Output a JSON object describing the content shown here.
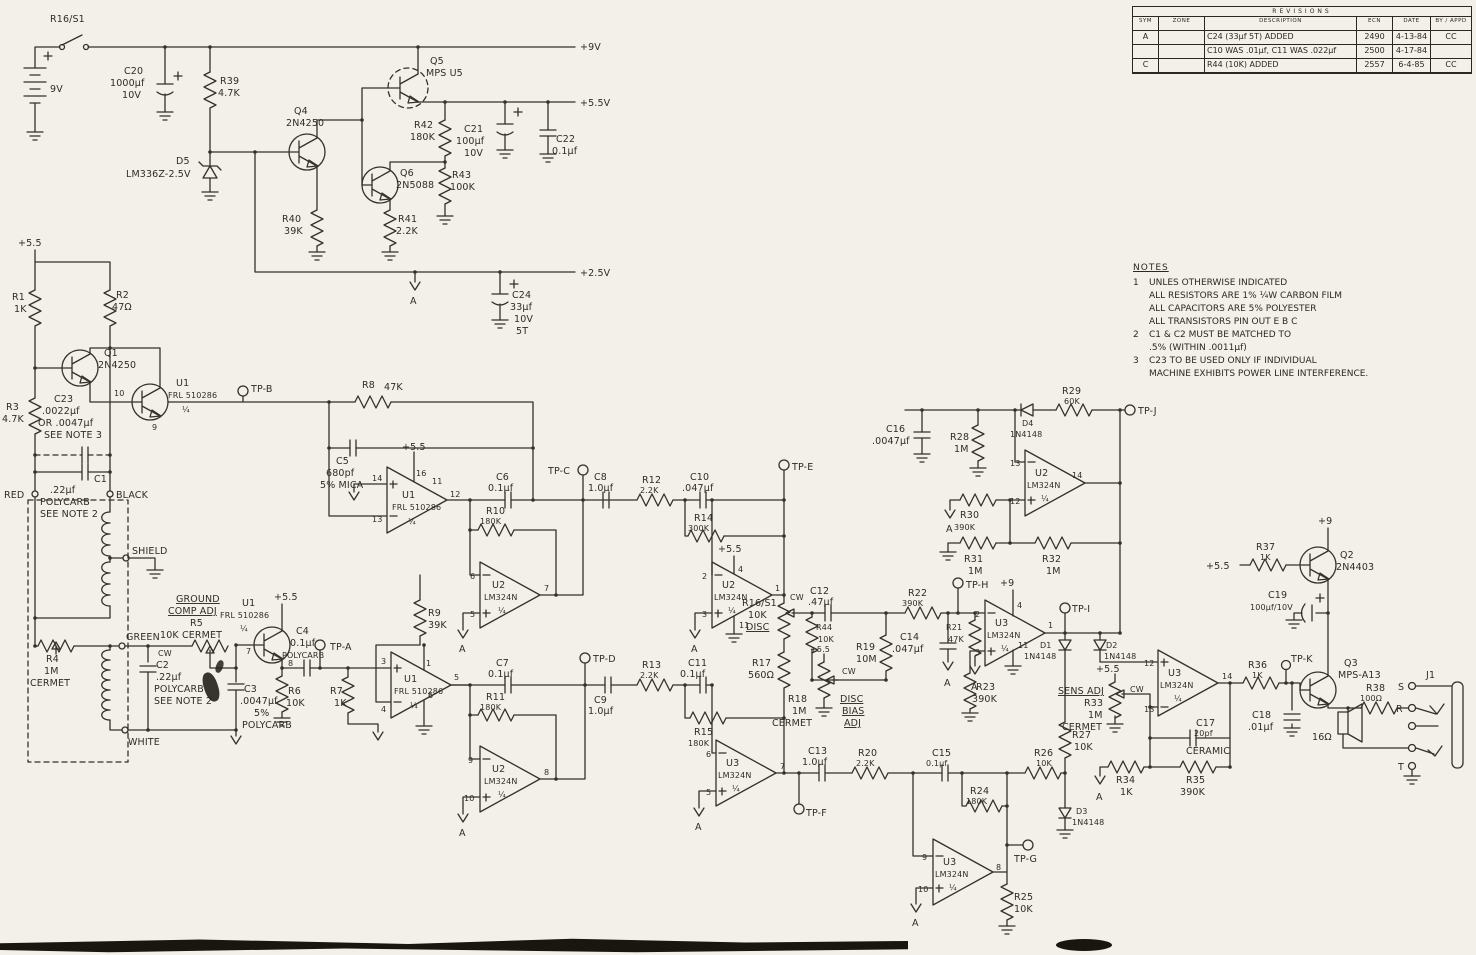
{
  "rev": {
    "title": "REVISIONS",
    "cols": [
      "SYM",
      "ZONE",
      "DESCRIPTION",
      "ECN",
      "DATE",
      "BY / APPD"
    ],
    "rows": [
      {
        "sym": "A",
        "zone": "",
        "desc": "C24 (33µf 5T) ADDED",
        "ecn": "2490",
        "date": "4-13-84",
        "by": "CC"
      },
      {
        "sym": "",
        "zone": "",
        "desc": "C10 WAS .01µf, C11 WAS .022µf",
        "ecn": "2500",
        "date": "4-17-84",
        "by": ""
      },
      {
        "sym": "C",
        "zone": "",
        "desc": "R44 (10K) ADDED",
        "ecn": "2557",
        "date": "6-4-85",
        "by": "CC"
      }
    ]
  },
  "notes": {
    "title": "NOTES",
    "l1": {
      "n": "1",
      "t": "UNLES OTHERWISE INDICATED"
    },
    "l2": {
      "n": "",
      "t": "ALL RESISTORS ARE 1% ¼W CARBON FILM"
    },
    "l3": {
      "n": "",
      "t": "ALL CAPACITORS ARE 5% POLYESTER"
    },
    "l4": {
      "n": "",
      "t": "ALL TRANSISTORS PIN OUT E B C"
    },
    "l5": {
      "n": "2",
      "t": "C1 & C2 MUST BE MATCHED TO"
    },
    "l6": {
      "n": "",
      "t": ".5% (WITHIN .0011µf)"
    },
    "l7": {
      "n": "3",
      "t": "C23 TO BE USED ONLY IF INDIVIDUAL"
    },
    "l8": {
      "n": "",
      "t": "MACHINE EXHIBITS POWER LINE INTERFERENCE."
    }
  },
  "rl": {
    "v9": "+9V",
    "v55": "+5.5V",
    "v25": "+2.5V",
    "p55": "+5.5",
    "p9": "+9"
  },
  "g": "A",
  "adj": {
    "cw": "CW",
    "gc1": "GROUND",
    "gc2": "COMP ADJ",
    "db1": "DISC",
    "db2": "BIAS",
    "db3": "ADJ",
    "sens": "SENS ADJ"
  },
  "wr": {
    "red": "RED",
    "black": "BLACK",
    "shield": "SHIELD",
    "green": "GREEN",
    "white": "WHITE"
  },
  "tp": {
    "a": "TP-A",
    "b": "TP-B",
    "c": "TP-C",
    "d": "TP-D",
    "e": "TP-E",
    "f": "TP-F",
    "g": "TP-G",
    "h": "TP-H",
    "i": "TP-I",
    "j": "TP-J",
    "k": "TP-K"
  },
  "pins": {
    "u1a": {
      "a": "10",
      "b": "9"
    },
    "u1b": {
      "a": "7",
      "b": "8"
    },
    "u1c": {
      "p": "14",
      "m": "13",
      "o": "12",
      "t": "16",
      "t2": "11"
    },
    "u1d": {
      "p": "3",
      "m": "4",
      "o": "5",
      "t": "1",
      "b": "6"
    },
    "u2a": {
      "m": "6",
      "p": "5",
      "o": "7"
    },
    "u2b": {
      "m": "2",
      "p": "3",
      "o": "1",
      "t": "4",
      "b": "11"
    },
    "u2c": {
      "m": "9",
      "p": "10",
      "o": "8"
    },
    "u2d": {
      "m": "13",
      "p": "12",
      "o": "14"
    },
    "u3a": {
      "m": "6",
      "p": "5",
      "o": "7"
    },
    "u3b": {
      "m": "2",
      "p": "3",
      "o": "1",
      "t": "4",
      "b": "11"
    },
    "u3c": {
      "m": "9",
      "p": "10",
      "o": "8"
    },
    "u3d": {
      "p": "12",
      "m": "13",
      "o": "14"
    }
  },
  "p": {
    "sw": {
      "r": "R16/S1"
    },
    "bat": {
      "v": "9V"
    },
    "c20": {
      "r": "C20",
      "v": "1000µf",
      "x": "10V"
    },
    "r39": {
      "r": "R39",
      "v": "4.7K"
    },
    "d5": {
      "r": "D5",
      "v": "LM336Z-2.5V"
    },
    "q4": {
      "r": "Q4",
      "v": "2N4250"
    },
    "q5": {
      "r": "Q5",
      "v": "MPS U5"
    },
    "q6": {
      "r": "Q6",
      "v": "2N5088"
    },
    "r40": {
      "r": "R40",
      "v": "39K"
    },
    "r41": {
      "r": "R41",
      "v": "2.2K"
    },
    "r42": {
      "r": "R42",
      "v": "180K"
    },
    "r43": {
      "r": "R43",
      "v": "100K"
    },
    "c21": {
      "r": "C21",
      "v": "100µf",
      "x": "10V"
    },
    "c22": {
      "r": "C22",
      "v": "0.1µf"
    },
    "c24": {
      "r": "C24",
      "v": "33µf",
      "x": "10V",
      "n": "5T"
    },
    "r1": {
      "r": "R1",
      "v": "1K"
    },
    "r2": {
      "r": "R2",
      "v": "47Ω"
    },
    "r3": {
      "r": "R3",
      "v": "4.7K"
    },
    "q1": {
      "r": "Q1",
      "v": "2N4250"
    },
    "c23": {
      "r": "C23",
      "v": ".0022µf",
      "x": "OR .0047µf",
      "n": "SEE NOTE 3"
    },
    "c1": {
      "r": "C1",
      "v": ".22µf",
      "x": "POLYCARB",
      "n": "SEE NOTE 2"
    },
    "r4": {
      "r": "R4",
      "v": "1M",
      "x": "CERMET"
    },
    "r5": {
      "r": "R5",
      "v": "10K CERMET"
    },
    "c2": {
      "r": "C2",
      "v": ".22µf",
      "x": "POLYCARB",
      "n": "SEE NOTE 2"
    },
    "c3": {
      "r": "C3",
      "v": ".0047µf",
      "x": "5%",
      "n": "POLYCARB"
    },
    "u1": {
      "r": "U1",
      "v": "FRL 510286",
      "f": "¼"
    },
    "u2": {
      "r": "U2",
      "v": "LM324N",
      "f": "¼"
    },
    "u3": {
      "r": "U3",
      "v": "LM324N",
      "f": "¼"
    },
    "r6": {
      "r": "R6",
      "v": "10K"
    },
    "c4": {
      "r": "C4",
      "v": "0.1µf",
      "x": "POLYCARB"
    },
    "r7": {
      "r": "R7",
      "v": "1K"
    },
    "r8": {
      "r": "R8",
      "v": "47K"
    },
    "c5": {
      "r": "C5",
      "v": "680pf",
      "x": "5% MICA"
    },
    "r9": {
      "r": "R9",
      "v": "39K"
    },
    "c6": {
      "r": "C6",
      "v": "0.1µf"
    },
    "r10": {
      "r": "R10",
      "v": "180K"
    },
    "c7": {
      "r": "C7",
      "v": "0.1µf"
    },
    "r11": {
      "r": "R11",
      "v": "180K"
    },
    "c8": {
      "r": "C8",
      "v": "1.0µf"
    },
    "c9": {
      "r": "C9",
      "v": "1.0µf"
    },
    "r12": {
      "r": "R12",
      "v": "2.2K"
    },
    "r13": {
      "r": "R13",
      "v": "2.2K"
    },
    "c10": {
      "r": "C10",
      "v": ".047µf"
    },
    "c11": {
      "r": "C11",
      "v": "0.1µf"
    },
    "r14": {
      "r": "R14",
      "v": "300K"
    },
    "r15": {
      "r": "R15",
      "v": "180K"
    },
    "r16": {
      "r": "R16/S1",
      "v": "10K",
      "x": "DISC"
    },
    "r17": {
      "r": "R17",
      "v": "560Ω"
    },
    "c12": {
      "r": "C12",
      "v": ".47µf"
    },
    "r44": {
      "r": "R44",
      "v": "10K"
    },
    "r19": {
      "r": "R19",
      "v": "10M"
    },
    "r18": {
      "r": "R18",
      "v": "1M",
      "x": "CERMET"
    },
    "r21": {
      "r": "R21",
      "v": "47K"
    },
    "c14": {
      "r": "C14",
      "v": ".047µf"
    },
    "r22": {
      "r": "R22",
      "v": "390K"
    },
    "r23": {
      "r": "R23",
      "v": "390K"
    },
    "d1": {
      "r": "D1",
      "v": "1N4148"
    },
    "d2": {
      "r": "D2",
      "v": "1N4148"
    },
    "c16": {
      "r": "C16",
      "v": ".0047µf"
    },
    "r28": {
      "r": "R28",
      "v": "1M"
    },
    "d4": {
      "r": "D4",
      "v": "1N4148"
    },
    "r29": {
      "r": "R29",
      "v": "60K"
    },
    "r30": {
      "r": "R30",
      "v": "390K"
    },
    "r31": {
      "r": "R31",
      "v": "1M"
    },
    "r32": {
      "r": "R32",
      "v": "1M"
    },
    "c13": {
      "r": "C13",
      "v": "1.0µf"
    },
    "r20": {
      "r": "R20",
      "v": "2.2K"
    },
    "c15": {
      "r": "C15",
      "v": "0.1µf"
    },
    "r24": {
      "r": "R24",
      "v": "180K"
    },
    "r26": {
      "r": "R26",
      "v": "10K"
    },
    "r25": {
      "r": "R25",
      "v": "10K"
    },
    "d3": {
      "r": "D3",
      "v": "1N4148"
    },
    "r27": {
      "r": "R27",
      "v": "10K"
    },
    "r33": {
      "r": "R33",
      "v": "1M",
      "x": "CERMET"
    },
    "c17": {
      "r": "C17",
      "v": "20pf",
      "x": "CERAMIC"
    },
    "r34": {
      "r": "R34",
      "v": "1K"
    },
    "r35": {
      "r": "R35",
      "v": "390K"
    },
    "r36": {
      "r": "R36",
      "v": "1K"
    },
    "c18": {
      "r": "C18",
      "v": ".01µf"
    },
    "q2": {
      "r": "Q2",
      "v": "2N4403"
    },
    "r37": {
      "r": "R37",
      "v": "1K"
    },
    "c19": {
      "r": "C19",
      "v": "100µf/10V"
    },
    "q3": {
      "r": "Q3",
      "v": "MPS-A13"
    },
    "r38": {
      "r": "R38",
      "v": "100Ω"
    },
    "spk": {
      "v": "16Ω"
    },
    "j1": {
      "r": "J1",
      "s": "S",
      "rg": "R",
      "t": "T"
    }
  }
}
